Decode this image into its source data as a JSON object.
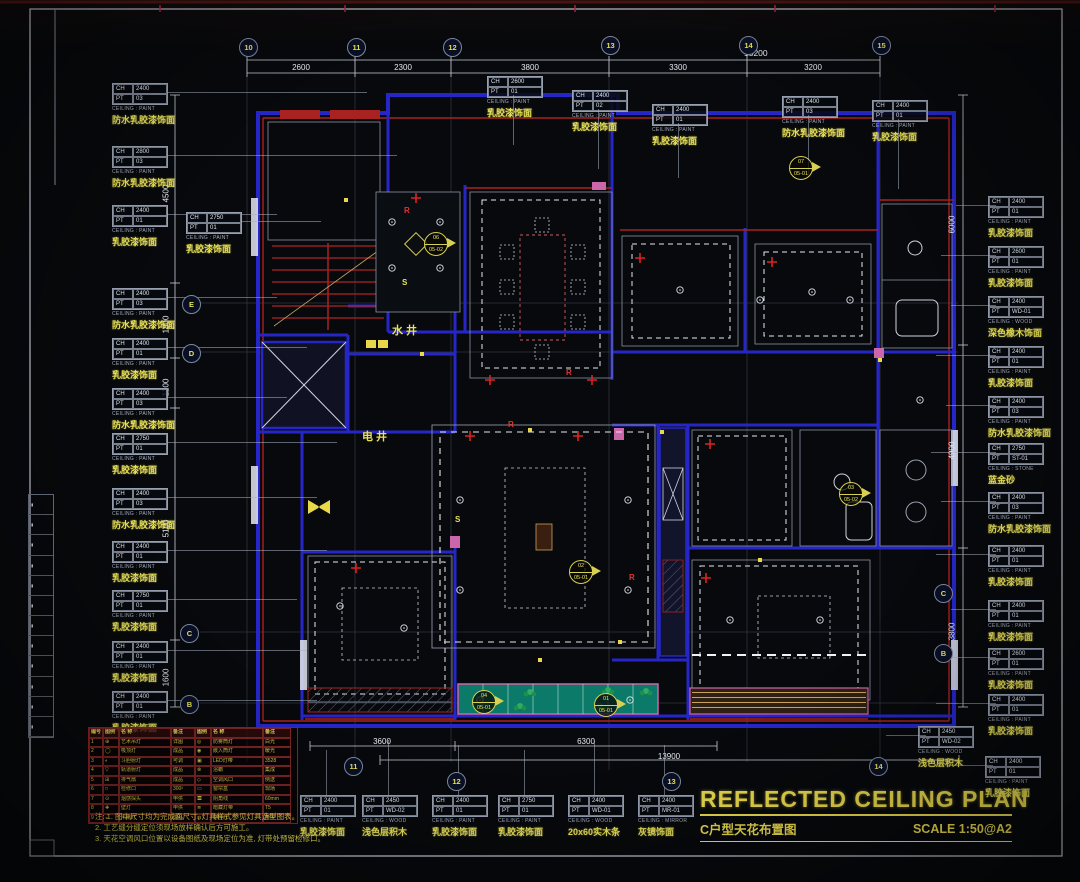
{
  "title": {
    "main": "REFLECTED CEILING PLAN",
    "sub": "C户型天花布置图",
    "scale": "SCALE 1:50@A2"
  },
  "colors": {
    "accent_yellow": "#e9e158",
    "wall_blue": "#2626c8",
    "wall_red": "#a82222",
    "balcony_teal": "#0c7a68",
    "line_white": "#cfd4dc"
  },
  "callout_keys": {
    "ch": "CH",
    "pt": "PT"
  },
  "callouts": [
    {
      "x": 112,
      "y": 83,
      "cls": "",
      "ch": "2400",
      "pt": "03",
      "type": "CEILING : PAINT",
      "material": "防水乳胶漆饰面",
      "lead": 200
    },
    {
      "x": 112,
      "y": 146,
      "cls": "",
      "ch": "2800",
      "pt": "03",
      "type": "CEILING : PAINT",
      "material": "防水乳胶漆饰面",
      "lead": 230
    },
    {
      "x": 112,
      "y": 205,
      "cls": "",
      "ch": "2400",
      "pt": "01",
      "type": "CEILING : PAINT",
      "material": "乳胶漆饰面",
      "lead": 110
    },
    {
      "x": 186,
      "y": 212,
      "cls": "",
      "ch": "2750",
      "pt": "01",
      "type": "CEILING : PAINT",
      "material": "乳胶漆饰面",
      "lead": 80
    },
    {
      "x": 112,
      "y": 288,
      "cls": "",
      "ch": "2400",
      "pt": "03",
      "type": "CEILING : PAINT",
      "material": "防水乳胶漆饰面",
      "lead": 110
    },
    {
      "x": 112,
      "y": 338,
      "cls": "",
      "ch": "2400",
      "pt": "01",
      "type": "CEILING : PAINT",
      "material": "乳胶漆饰面",
      "lead": 140
    },
    {
      "x": 112,
      "y": 388,
      "cls": "",
      "ch": "2400",
      "pt": "03",
      "type": "CEILING : PAINT",
      "material": "防水乳胶漆饰面",
      "lead": 120
    },
    {
      "x": 112,
      "y": 433,
      "cls": "",
      "ch": "2750",
      "pt": "01",
      "type": "CEILING : PAINT",
      "material": "乳胶漆饰面",
      "lead": 170
    },
    {
      "x": 112,
      "y": 488,
      "cls": "",
      "ch": "2400",
      "pt": "03",
      "type": "CEILING : PAINT",
      "material": "防水乳胶漆饰面",
      "lead": 150
    },
    {
      "x": 112,
      "y": 541,
      "cls": "",
      "ch": "2400",
      "pt": "01",
      "type": "CEILING : PAINT",
      "material": "乳胶漆饰面",
      "lead": 160
    },
    {
      "x": 112,
      "y": 590,
      "cls": "",
      "ch": "2750",
      "pt": "01",
      "type": "CEILING : PAINT",
      "material": "乳胶漆饰面",
      "lead": 130
    },
    {
      "x": 112,
      "y": 641,
      "cls": "",
      "ch": "2400",
      "pt": "01",
      "type": "CEILING : PAINT",
      "material": "乳胶漆饰面",
      "lead": 140
    },
    {
      "x": 112,
      "y": 691,
      "cls": "",
      "ch": "2400",
      "pt": "01",
      "type": "CEILING : PAINT",
      "material": "乳胶漆饰面",
      "lead": 150
    },
    {
      "x": 487,
      "y": 76,
      "cls": "t",
      "ch": "2600",
      "pt": "01",
      "type": "CEILING : PAINT",
      "material": "乳胶漆饰面",
      "lead": 50
    },
    {
      "x": 572,
      "y": 90,
      "cls": "t",
      "ch": "2400",
      "pt": "02",
      "type": "CEILING : PAINT",
      "material": "乳胶漆饰面",
      "lead": 60
    },
    {
      "x": 652,
      "y": 104,
      "cls": "t",
      "ch": "2400",
      "pt": "01",
      "type": "CEILING : PAINT",
      "material": "乳胶漆饰面",
      "lead": 55
    },
    {
      "x": 782,
      "y": 96,
      "cls": "t",
      "ch": "2400",
      "pt": "03",
      "type": "CEILING : PAINT",
      "material": "防水乳胶漆饰面",
      "lead": 60
    },
    {
      "x": 872,
      "y": 100,
      "cls": "t",
      "ch": "2400",
      "pt": "01",
      "type": "CEILING : PAINT",
      "material": "乳胶漆饰面",
      "lead": 70
    },
    {
      "x": 988,
      "y": 196,
      "cls": "r",
      "ch": "2400",
      "pt": "01",
      "type": "CEILING : PAINT",
      "material": "乳胶漆饰面",
      "lead": 40
    },
    {
      "x": 988,
      "y": 246,
      "cls": "r",
      "ch": "2600",
      "pt": "01",
      "type": "CEILING : PAINT",
      "material": "乳胶漆饰面",
      "lead": 55
    },
    {
      "x": 988,
      "y": 296,
      "cls": "r",
      "ch": "2400",
      "pt": "WD-01",
      "type": "CEILING : WOOD",
      "material": "深色橡木饰面",
      "lead": 45
    },
    {
      "x": 988,
      "y": 346,
      "cls": "r",
      "ch": "2400",
      "pt": "01",
      "type": "CEILING : PAINT",
      "material": "乳胶漆饰面",
      "lead": 60
    },
    {
      "x": 988,
      "y": 396,
      "cls": "r",
      "ch": "2400",
      "pt": "03",
      "type": "CEILING : PAINT",
      "material": "防水乳胶漆饰面",
      "lead": 50
    },
    {
      "x": 988,
      "y": 443,
      "cls": "r",
      "ch": "2750",
      "pt": "ST-01",
      "type": "CEILING : STONE",
      "material": "蓝金砂",
      "lead": 65
    },
    {
      "x": 988,
      "y": 492,
      "cls": "r",
      "ch": "2400",
      "pt": "03",
      "type": "CEILING : PAINT",
      "material": "防水乳胶漆饰面",
      "lead": 55
    },
    {
      "x": 988,
      "y": 545,
      "cls": "r",
      "ch": "2400",
      "pt": "01",
      "type": "CEILING : PAINT",
      "material": "乳胶漆饰面",
      "lead": 60
    },
    {
      "x": 988,
      "y": 600,
      "cls": "r",
      "ch": "2400",
      "pt": "01",
      "type": "CEILING : PAINT",
      "material": "乳胶漆饰面",
      "lead": 45
    },
    {
      "x": 988,
      "y": 648,
      "cls": "r",
      "ch": "2600",
      "pt": "01",
      "type": "CEILING : PAINT",
      "material": "乳胶漆饰面",
      "lead": 55
    },
    {
      "x": 988,
      "y": 694,
      "cls": "r",
      "ch": "2400",
      "pt": "01",
      "type": "CEILING : PAINT",
      "material": "乳胶漆饰面",
      "lead": 60
    },
    {
      "x": 918,
      "y": 726,
      "cls": "r",
      "ch": "2450",
      "pt": "WD-02",
      "type": "CEILING : WOOD",
      "material": "浅色层积木",
      "lead": 40
    },
    {
      "x": 985,
      "y": 756,
      "cls": "r",
      "ch": "2400",
      "pt": "01",
      "type": "CEILING : PAINT",
      "material": "乳胶漆饰面",
      "lead": 45
    },
    {
      "x": 300,
      "y": 795,
      "cls": "b",
      "ch": "2400",
      "pt": "01",
      "type": "CEILING : PAINT",
      "material": "乳胶漆饰面",
      "lead": 45
    },
    {
      "x": 362,
      "y": 795,
      "cls": "b",
      "ch": "2450",
      "pt": "WD-02",
      "type": "CEILING : WOOD",
      "material": "浅色层积木",
      "lead": 55
    },
    {
      "x": 432,
      "y": 795,
      "cls": "b",
      "ch": "2400",
      "pt": "01",
      "type": "CEILING : PAINT",
      "material": "乳胶漆饰面",
      "lead": 50
    },
    {
      "x": 498,
      "y": 795,
      "cls": "b",
      "ch": "2750",
      "pt": "01",
      "type": "CEILING : PAINT",
      "material": "乳胶漆饰面",
      "lead": 45
    },
    {
      "x": 568,
      "y": 795,
      "cls": "b",
      "ch": "2400",
      "pt": "WD-01",
      "type": "CEILING : WOOD",
      "material": "20x60实木条",
      "lead": 55
    },
    {
      "x": 638,
      "y": 795,
      "cls": "b",
      "ch": "2400",
      "pt": "MR-01",
      "type": "CEILING : MIRROR",
      "material": "灰镜饰面",
      "lead": 50
    }
  ],
  "bubbles": [
    {
      "x": 239,
      "y": 38,
      "t": "10"
    },
    {
      "x": 347,
      "y": 38,
      "t": "11"
    },
    {
      "x": 443,
      "y": 38,
      "t": "12"
    },
    {
      "x": 601,
      "y": 36,
      "t": "13"
    },
    {
      "x": 739,
      "y": 36,
      "t": "14"
    },
    {
      "x": 872,
      "y": 36,
      "t": "15"
    },
    {
      "x": 182,
      "y": 295,
      "t": "E"
    },
    {
      "x": 182,
      "y": 344,
      "t": "D"
    },
    {
      "x": 180,
      "y": 624,
      "t": "C"
    },
    {
      "x": 180,
      "y": 695,
      "t": "B"
    },
    {
      "x": 344,
      "y": 757,
      "t": "11"
    },
    {
      "x": 447,
      "y": 772,
      "t": "12"
    },
    {
      "x": 662,
      "y": 772,
      "t": "13"
    },
    {
      "x": 869,
      "y": 757,
      "t": "14"
    },
    {
      "x": 934,
      "y": 584,
      "t": "C"
    },
    {
      "x": 934,
      "y": 644,
      "t": "B"
    }
  ],
  "dims": {
    "top_total": "15200",
    "top": [
      {
        "x": 301,
        "y": 63,
        "v": "2600"
      },
      {
        "x": 403,
        "y": 63,
        "v": "2300"
      },
      {
        "x": 530,
        "y": 63,
        "v": "3800"
      },
      {
        "x": 678,
        "y": 63,
        "v": "3300"
      },
      {
        "x": 813,
        "y": 63,
        "v": "3200"
      }
    ],
    "left": [
      {
        "x": 166,
        "y": 189,
        "v": "4500"
      },
      {
        "x": 166,
        "y": 320,
        "v": "1800"
      },
      {
        "x": 166,
        "y": 383,
        "v": "1200"
      },
      {
        "x": 166,
        "y": 524,
        "v": "5100"
      },
      {
        "x": 166,
        "y": 673,
        "v": "1600"
      }
    ],
    "right": [
      {
        "x": 952,
        "y": 220,
        "v": "6000"
      },
      {
        "x": 952,
        "y": 446,
        "v": "4900"
      },
      {
        "x": 952,
        "y": 627,
        "v": "3800"
      }
    ],
    "bottom": [
      {
        "x": 382,
        "y": 737,
        "v": "3600"
      },
      {
        "x": 586,
        "y": 737,
        "v": "6300"
      },
      {
        "x": 669,
        "y": 752,
        "v": "13900"
      }
    ]
  },
  "section_markers": [
    {
      "x": 424,
      "y": 232,
      "a": "06",
      "b": "05-02"
    },
    {
      "x": 789,
      "y": 156,
      "a": "07",
      "b": "05-01"
    },
    {
      "x": 569,
      "y": 560,
      "a": "02",
      "b": "05-01"
    },
    {
      "x": 472,
      "y": 690,
      "a": "04",
      "b": "05-01"
    },
    {
      "x": 594,
      "y": 693,
      "a": "01",
      "b": "05-01"
    },
    {
      "x": 839,
      "y": 482,
      "a": "03",
      "b": "05-02"
    }
  ],
  "interior_labels": [
    {
      "x": 392,
      "y": 322,
      "t": "水井",
      "cls": ""
    },
    {
      "x": 362,
      "y": 428,
      "t": "电井",
      "cls": ""
    },
    {
      "x": 404,
      "y": 206,
      "t": "R",
      "cls": "red"
    },
    {
      "x": 566,
      "y": 368,
      "t": "R",
      "cls": "red"
    },
    {
      "x": 508,
      "y": 420,
      "t": "R",
      "cls": "red"
    },
    {
      "x": 629,
      "y": 573,
      "t": "R",
      "cls": "red"
    },
    {
      "x": 402,
      "y": 278,
      "t": "S",
      "cls": "yel"
    },
    {
      "x": 455,
      "y": 515,
      "t": "S",
      "cls": "yel"
    }
  ],
  "legend": {
    "headers": {
      "h1": "编号",
      "h2": "图例",
      "h3": "名  称",
      "h4": "备注",
      "h5": "图例",
      "h6": "名  称",
      "h7": "备注"
    },
    "rows": [
      {
        "c1": "1",
        "c2": "⊕",
        "c3": "艺术吊灯",
        "c4": "详图",
        "c5": "◎",
        "c6": "防雾筒灯",
        "c7": "白光"
      },
      {
        "c1": "2",
        "c2": "◯",
        "c3": "吸顶灯",
        "c4": "成品",
        "c5": "◉",
        "c6": "嵌入筒灯",
        "c7": "暖光"
      },
      {
        "c1": "3",
        "c2": "◐",
        "c3": "斗胆射灯",
        "c4": "可调",
        "c5": "▣",
        "c6": "LED灯带",
        "c7": "3528"
      },
      {
        "c1": "4",
        "c2": "▽",
        "c3": "轨道射灯",
        "c4": "成品",
        "c5": "⊗",
        "c6": "浴霸",
        "c7": "集成"
      },
      {
        "c1": "5",
        "c2": "⊞",
        "c3": "排气扇",
        "c4": "成品",
        "c5": "◇",
        "c6": "空调风口",
        "c7": "侧送"
      },
      {
        "c1": "6",
        "c2": "□",
        "c3": "检修口",
        "c4": "300²",
        "c5": "▭",
        "c6": "窗帘盒",
        "c7": "现场"
      },
      {
        "c1": "7",
        "c2": "⊙",
        "c3": "烟感探头",
        "c4": "甲供",
        "c5": "〓",
        "c6": "阴角线",
        "c7": "60mm"
      },
      {
        "c1": "8",
        "c2": "✚",
        "c3": "壁灯",
        "c4": "甲供",
        "c5": "≣",
        "c6": "暗藏灯带",
        "c7": "T5"
      },
      {
        "c1": "9",
        "c2": "◒",
        "c3": "吊扇灯",
        "c4": "成品",
        "c5": "◍",
        "c6": "感应灯",
        "c7": "声控"
      }
    ]
  },
  "notes": [
    {
      "t": "注: 1. 图中尺寸均为完成面尺寸, 灯具样式参见灯具选型图表。"
    },
    {
      "t": "2. 工艺缝分缝定位须现场放样确认后方可施工。"
    },
    {
      "t": "3. 天花空调风口位置以设备图纸及现场定位为准, 灯带处预留检修口。"
    }
  ],
  "edge_table": {
    "rows": [
      {
        "t": "▮"
      },
      {
        "t": "▮"
      },
      {
        "t": "▮"
      },
      {
        "t": "▮"
      },
      {
        "t": "▮"
      },
      {
        "t": "▮"
      },
      {
        "t": "▮"
      },
      {
        "t": "▮"
      },
      {
        "t": "▮"
      },
      {
        "t": "▮"
      },
      {
        "t": "▮"
      },
      {
        "t": "▮"
      }
    ]
  }
}
